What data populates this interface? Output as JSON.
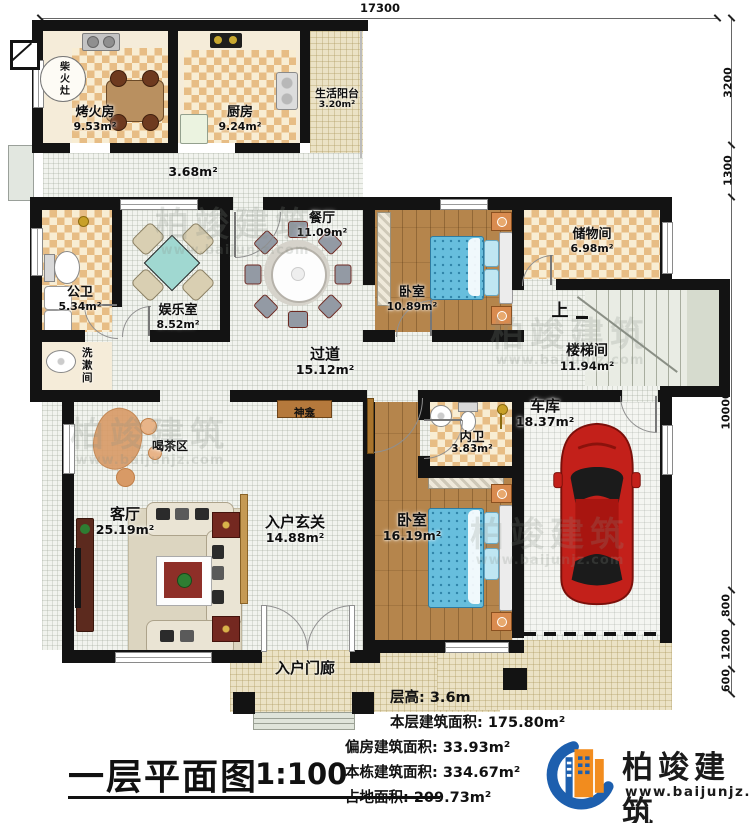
{
  "dimensions": {
    "top": "17300",
    "right": [
      "3200",
      "1300",
      "10000",
      "800",
      "1200",
      "600"
    ]
  },
  "rooms": {
    "chaihuozao": {
      "name": "柴火灶"
    },
    "kaohuofang": {
      "name": "烤火房",
      "area": "9.53m²"
    },
    "chufang": {
      "name": "厨房",
      "area": "9.24m²"
    },
    "shenghuoyangtai": {
      "name": "生活阳台",
      "area": "3.20m²"
    },
    "annex_corridor": {
      "area": "3.68m²"
    },
    "gongwei": {
      "name": "公卫",
      "area": "5.34m²"
    },
    "xishujian": {
      "name": "洗漱间"
    },
    "yuleshi": {
      "name": "娱乐室",
      "area": "8.52m²"
    },
    "canting": {
      "name": "餐厅",
      "area": "11.09m²"
    },
    "woshi1": {
      "name": "卧室",
      "area": "10.89m²"
    },
    "chuwujian": {
      "name": "储物间",
      "area": "6.98m²"
    },
    "loutijian": {
      "name": "楼梯间",
      "area": "11.94m²"
    },
    "shang": {
      "name": "上"
    },
    "guodao": {
      "name": "过道",
      "area": "15.12m²"
    },
    "shenkan": {
      "name": "神龛"
    },
    "hechaqu": {
      "name": "喝茶区"
    },
    "keting": {
      "name": "客厅",
      "area": "25.19m²"
    },
    "ruhuxuanguan": {
      "name": "入户玄关",
      "area": "14.88m²"
    },
    "neiwei": {
      "name": "内卫",
      "area": "3.83m²"
    },
    "cheku": {
      "name": "车库",
      "area": "18.37m²"
    },
    "woshi2": {
      "name": "卧室",
      "area": "16.19m²"
    },
    "ruhumenlang": {
      "name": "入户门廊"
    }
  },
  "titleblock": {
    "title": "一层平面图",
    "scale": "1:100"
  },
  "stats": {
    "lines": [
      "层高: 3.6m",
      "本层建筑面积: 175.80m²",
      "偏房建筑面积: 33.93m²",
      "本栋建筑面积: 334.67m²",
      "占地面积: 209.73m²"
    ]
  },
  "logo": {
    "name": "柏竣建筑",
    "url": "www.baijunjz.com"
  },
  "watermark": {
    "text": "柏竣建筑",
    "url": "www.baijunjz.com"
  }
}
